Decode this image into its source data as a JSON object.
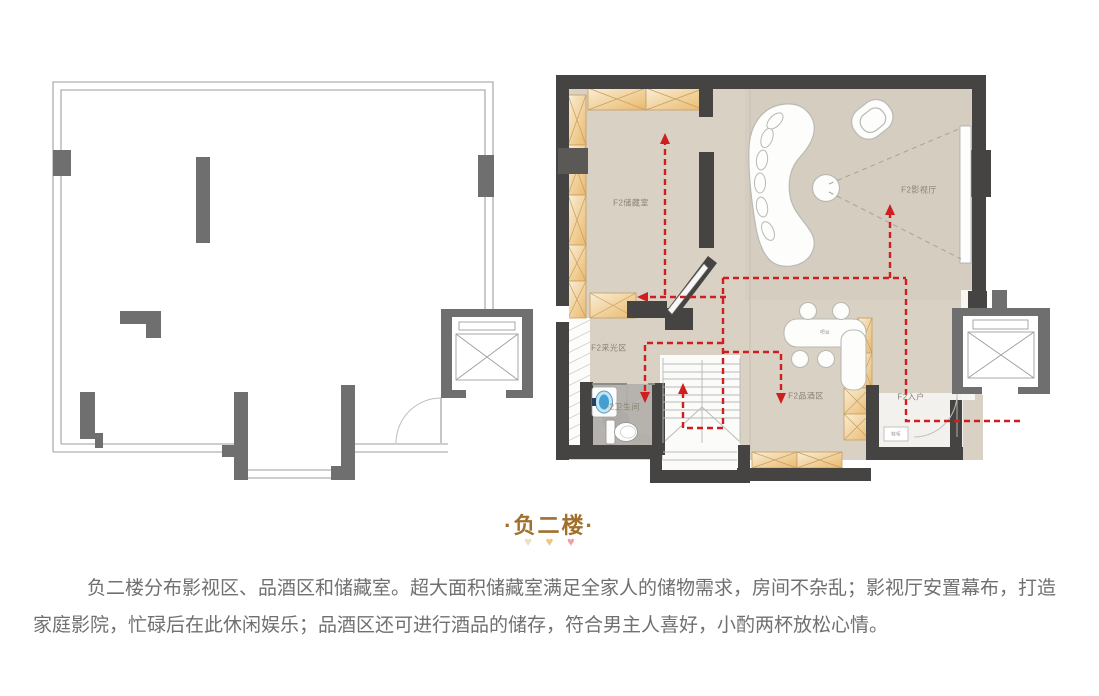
{
  "title": {
    "text": "·负二楼·",
    "hearts": [
      {
        "glyph": "♥",
        "style": "color:#ece0c3"
      },
      {
        "glyph": "♥",
        "style": "color:#eec878"
      },
      {
        "glyph": "♥",
        "style": "color:#f2a0a4"
      }
    ]
  },
  "description": "负二楼分布影视区、品酒区和储藏室。超大面积储藏室满足全家人的储物需求，房间不杂乱；影视厅安置幕布，打造家庭影院，忙碌后在此休闲娱乐；品酒区还可进行酒品的储存，符合男主人喜好，小酌两杯放松心情。",
  "floor_plan_labels": {
    "storage": "F2储藏室",
    "cinema": "F2影视厅",
    "daylight": "F2采光区",
    "bathroom": "F2卫生间",
    "wine": "F2品酒区",
    "entry": "F2入户",
    "bar_counter": "吧台",
    "shoe_cabinet": "鞋柜"
  },
  "colors": {
    "accent_red": "#ce1e1e",
    "wall_dark": "#454442",
    "column_gray": "#6f6f6f",
    "floor_beige": "#d8d1c4",
    "cabinet_orange": "#eab96d",
    "title_brown": "#a1702d",
    "body_text_gray": "#707070"
  }
}
